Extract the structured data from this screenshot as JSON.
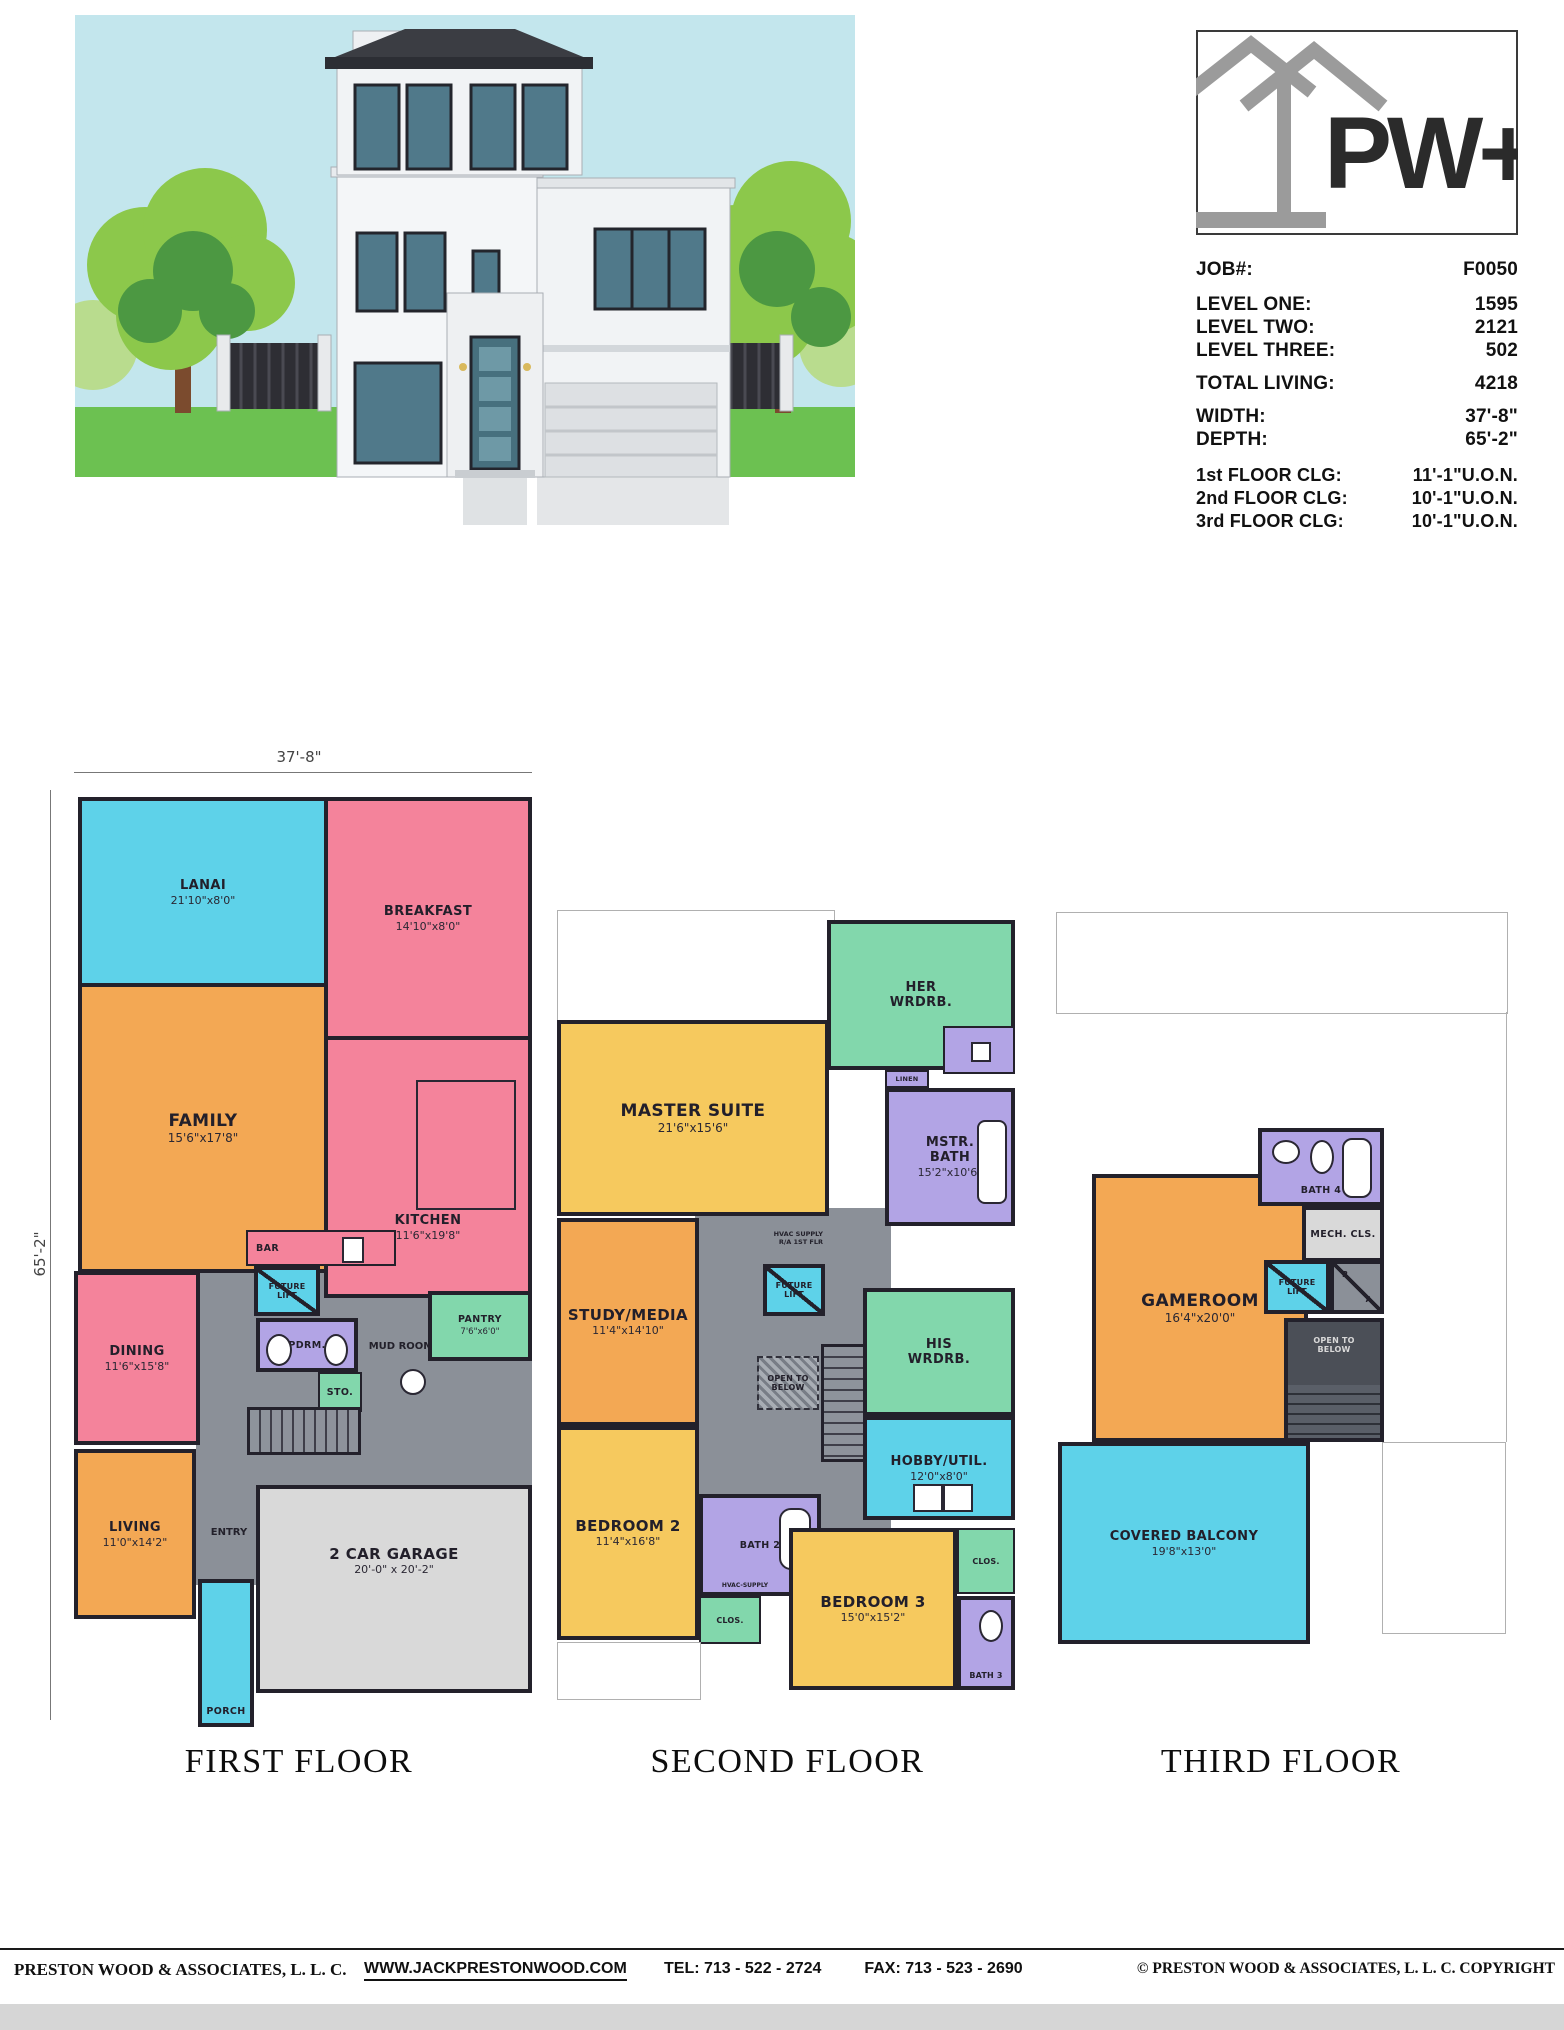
{
  "logo": {
    "text": "PW+A"
  },
  "job_info": {
    "rows": [
      {
        "label": "JOB#:",
        "value": "F0050"
      },
      {
        "label": "LEVEL ONE:",
        "value": "1595"
      },
      {
        "label": "LEVEL TWO:",
        "value": "2121"
      },
      {
        "label": "LEVEL THREE:",
        "value": "502"
      },
      {
        "label": "TOTAL LIVING:",
        "value": "4218"
      },
      {
        "label": "WIDTH:",
        "value": "37'-8\""
      },
      {
        "label": "DEPTH:",
        "value": "65'-2\""
      },
      {
        "label": "1st FLOOR CLG:",
        "value": "11'-1\"U.O.N."
      },
      {
        "label": "2nd FLOOR CLG:",
        "value": "10'-1\"U.O.N."
      },
      {
        "label": "3rd FLOOR CLG:",
        "value": "10'-1\"U.O.N."
      }
    ]
  },
  "floors": {
    "first": {
      "title": "FIRST FLOOR",
      "width_dim": "37'-8\"",
      "depth_dim": "65'-2\"",
      "rooms": {
        "lanai": {
          "name": "LANAI",
          "dims": "21'10\"x8'0\""
        },
        "breakfast": {
          "name": "BREAKFAST",
          "dims": "14'10\"x8'0\""
        },
        "family": {
          "name": "FAMILY",
          "dims": "15'6\"x17'8\""
        },
        "kitchen": {
          "name": "KITCHEN",
          "dims": "11'6\"x19'8\""
        },
        "bar": {
          "name": "BAR"
        },
        "pantry": {
          "name": "PANTRY",
          "dims": "7'6\"x6'0\""
        },
        "future_lift": {
          "name": "FUTURE LIFT"
        },
        "powder": {
          "name": "PDRM."
        },
        "mud_room": {
          "name": "MUD ROOM"
        },
        "storage": {
          "name": "STO."
        },
        "dining": {
          "name": "DINING",
          "dims": "11'6\"x15'8\""
        },
        "living": {
          "name": "LIVING",
          "dims": "11'0\"x14'2\""
        },
        "entry": {
          "name": "ENTRY"
        },
        "garage": {
          "name": "2 CAR GARAGE",
          "dims": "20'-0\" x 20'-2\""
        },
        "porch": {
          "name": "PORCH"
        }
      }
    },
    "second": {
      "title": "SECOND FLOOR",
      "rooms": {
        "her_wrdrb": {
          "name": "HER WRDRB."
        },
        "linen": {
          "name": "LINEN"
        },
        "mstr_bath": {
          "name": "MSTR. BATH",
          "dims": "15'2\"x10'6\""
        },
        "master_suite": {
          "name": "MASTER SUITE",
          "dims": "21'6\"x15'6\""
        },
        "study_media": {
          "name": "STUDY/MEDIA",
          "dims": "11'4\"x14'10\""
        },
        "hvac_supply": {
          "name": "HVAC SUPPLY"
        },
        "ra_1st_flr": {
          "name": "R/A 1ST FLR"
        },
        "future_lift": {
          "name": "FUTURE LIFT"
        },
        "open_below": {
          "name": "OPEN TO BELOW"
        },
        "his_wrdrb": {
          "name": "HIS WRDRB."
        },
        "hobby_util": {
          "name": "HOBBY/UTIL.",
          "dims": "12'0\"x8'0\""
        },
        "bedroom2": {
          "name": "BEDROOM 2",
          "dims": "11'4\"x16'8\""
        },
        "bath2": {
          "name": "BATH 2"
        },
        "hvac_supply2": {
          "name": "HVAC-SUPPLY"
        },
        "clos_left": {
          "name": "CLOS."
        },
        "bedroom3": {
          "name": "BEDROOM 3",
          "dims": "15'0\"x15'2\""
        },
        "bath3": {
          "name": "BATH 3"
        },
        "clos_right": {
          "name": "CLOS."
        }
      }
    },
    "third": {
      "title": "THIRD FLOOR",
      "rooms": {
        "bath4": {
          "name": "BATH 4"
        },
        "mech_cls": {
          "name": "MECH. CLS."
        },
        "gameroom": {
          "name": "GAMEROOM",
          "dims": "16'4\"x20'0\""
        },
        "future_lift": {
          "name": "FUTURE LIFT"
        },
        "ra_r": {
          "name": "R"
        },
        "ra_a": {
          "name": "A"
        },
        "open_below": {
          "name": "OPEN TO BELOW"
        },
        "covered_balcony": {
          "name": "COVERED BALCONY",
          "dims": "19'8\"x13'0\""
        }
      }
    }
  },
  "footer": {
    "company": "PRESTON WOOD & ASSOCIATES, L. L. C.",
    "website": "WWW.JACKPRESTONWOOD.COM",
    "tel": "TEL:  713 - 522 - 2724",
    "fax": "FAX:  713 - 523 - 2690",
    "copyright": "© PRESTON WOOD & ASSOCIATES, L. L. C.  COPYRIGHT"
  },
  "colors": {
    "room_cyan": "#5ed2e9",
    "room_pink": "#f4839b",
    "room_orange": "#f3a854",
    "room_yellow": "#f6c95e",
    "room_green": "#82d7ac",
    "room_purple": "#b2a4e5",
    "circulation_gray": "#8b9098",
    "garage_gray": "#d9d9d9",
    "wall": "#23212b",
    "sky": "#c3e6ed",
    "grass": "#6cc151",
    "tree_light": "#8cc84b",
    "tree_dark": "#4c9842",
    "window_teal": "#50798a",
    "roof_dark": "#3b3d43",
    "logo_gray": "#9b9b9b"
  }
}
